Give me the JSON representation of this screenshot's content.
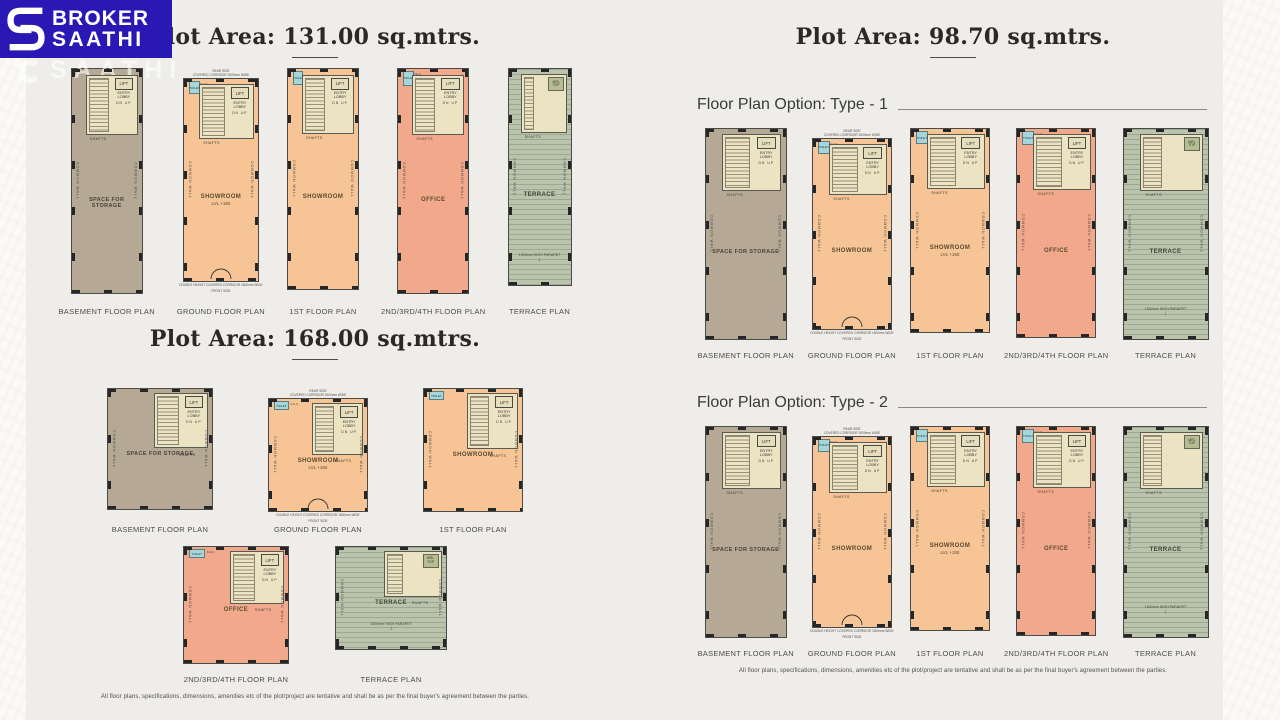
{
  "logo": {
    "brand_line1": "BROKER",
    "brand_line2": "SAATHI",
    "watermark": "SAATHI",
    "bg_color": "#2a18b4"
  },
  "disclaimer": "All floor plans, specifications, dimensions, amenities etc of the plot/project are tentative and shall be as per the final buyer's agreement between the parties.",
  "colors": {
    "accent_blue": "#2a18b4",
    "wall": "#4a4a47",
    "basement_fill": "#b5a894",
    "showroom_fill": "#f6c495",
    "office_fill": "#f2a98b",
    "terrace_fill": "#bac3ac",
    "stair_fill": "#ece3c3",
    "toilet_fill": "#a5d6da"
  },
  "plan_annotations": {
    "lift": "LIFT",
    "entry_lobby": "ENTRY LOBBY",
    "shafts": "SHAFTS",
    "common_wall": "COMMON WALL",
    "up": "UP",
    "dn": "DN",
    "toilet": "TOILET",
    "fhc": "F.H.C",
    "rear_side": "REAR SIDE",
    "front_side": "FRONT SIDE",
    "covered_corridor": "COVERED CORRIDOR 2000mm WIDE",
    "double_height_corridor": "DOUBLE HEIGHT COVERED CORRIDOR 1500mm WIDE",
    "parapet": "1500mm HIGH PARAPET",
    "mrl_top": "MRL TOP"
  },
  "left": {
    "sections": [
      {
        "title": "Plot Area: 131.00 sq.mtrs.",
        "rows": [
          {
            "plans": [
              {
                "label": "BASEMENT FLOOR PLAN",
                "room": "SPACE FOR STORAGE",
                "kind": "basement",
                "w": 72,
                "h": 226
              },
              {
                "label": "GROUND FLOOR PLAN",
                "room": "SHOWROOM",
                "room2": "LVL +150",
                "kind": "ground",
                "w": 76,
                "h": 204
              },
              {
                "label": "1ST FLOOR PLAN",
                "room": "SHOWROOM",
                "kind": "first",
                "w": 72,
                "h": 222
              },
              {
                "label": "2ND/3RD/4TH FLOOR PLAN",
                "room": "OFFICE",
                "kind": "office",
                "w": 72,
                "h": 226
              },
              {
                "label": "TERRACE PLAN",
                "room": "TERRACE",
                "kind": "terrace",
                "w": 64,
                "h": 218
              }
            ]
          }
        ]
      },
      {
        "title": "Plot Area: 168.00 sq.mtrs.",
        "rows": [
          {
            "plans": [
              {
                "label": "BASEMENT FLOOR PLAN",
                "room": "SPACE FOR STORAGE",
                "kind": "basement",
                "w": 106,
                "h": 122
              },
              {
                "label": "GROUND FLOOR PLAN",
                "room": "SHOWROOM",
                "room2": "LVL +150",
                "kind": "ground",
                "w": 100,
                "h": 114
              },
              {
                "label": "1ST FLOOR PLAN",
                "room": "SHOWROOM",
                "kind": "first",
                "w": 100,
                "h": 124
              }
            ]
          },
          {
            "plans": [
              {
                "label": "2ND/3RD/4TH FLOOR PLAN",
                "room": "OFFICE",
                "kind": "office",
                "w": 106,
                "h": 118
              },
              {
                "label": "TERRACE PLAN",
                "room": "TERRACE",
                "kind": "terrace",
                "w": 112,
                "h": 104
              }
            ]
          }
        ]
      }
    ]
  },
  "right": {
    "title": "Plot Area: 98.70 sq.mtrs.",
    "options": [
      {
        "heading": "Floor Plan Option: Type - 1",
        "plans": [
          {
            "label": "BASEMENT FLOOR PLAN",
            "room": "SPACE FOR STORAGE",
            "kind": "basement",
            "w": 82,
            "h": 212
          },
          {
            "label": "GROUND FLOOR PLAN",
            "room": "SHOWROOM",
            "kind": "ground",
            "w": 80,
            "h": 192
          },
          {
            "label": "1ST FLOOR PLAN",
            "room": "SHOWROOM",
            "room2": "LVL +150",
            "kind": "first",
            "w": 80,
            "h": 205
          },
          {
            "label": "2ND/3RD/4TH FLOOR PLAN",
            "room": "OFFICE",
            "kind": "office",
            "w": 80,
            "h": 210
          },
          {
            "label": "TERRACE PLAN",
            "room": "TERRACE",
            "kind": "terrace",
            "w": 86,
            "h": 212
          }
        ]
      },
      {
        "heading": "Floor Plan Option: Type - 2",
        "plans": [
          {
            "label": "BASEMENT FLOOR PLAN",
            "room": "SPACE FOR STORAGE",
            "kind": "basement",
            "w": 82,
            "h": 212
          },
          {
            "label": "GROUND FLOOR PLAN",
            "room": "SHOWROOM",
            "kind": "ground",
            "w": 80,
            "h": 192
          },
          {
            "label": "1ST FLOOR PLAN",
            "room": "SHOWROOM",
            "room2": "LVL +150",
            "kind": "first",
            "w": 80,
            "h": 205
          },
          {
            "label": "2ND/3RD/4TH FLOOR PLAN",
            "room": "OFFICE",
            "kind": "office",
            "w": 80,
            "h": 210
          },
          {
            "label": "TERRACE PLAN",
            "room": "TERRACE",
            "kind": "terrace",
            "w": 86,
            "h": 212
          }
        ]
      }
    ]
  }
}
